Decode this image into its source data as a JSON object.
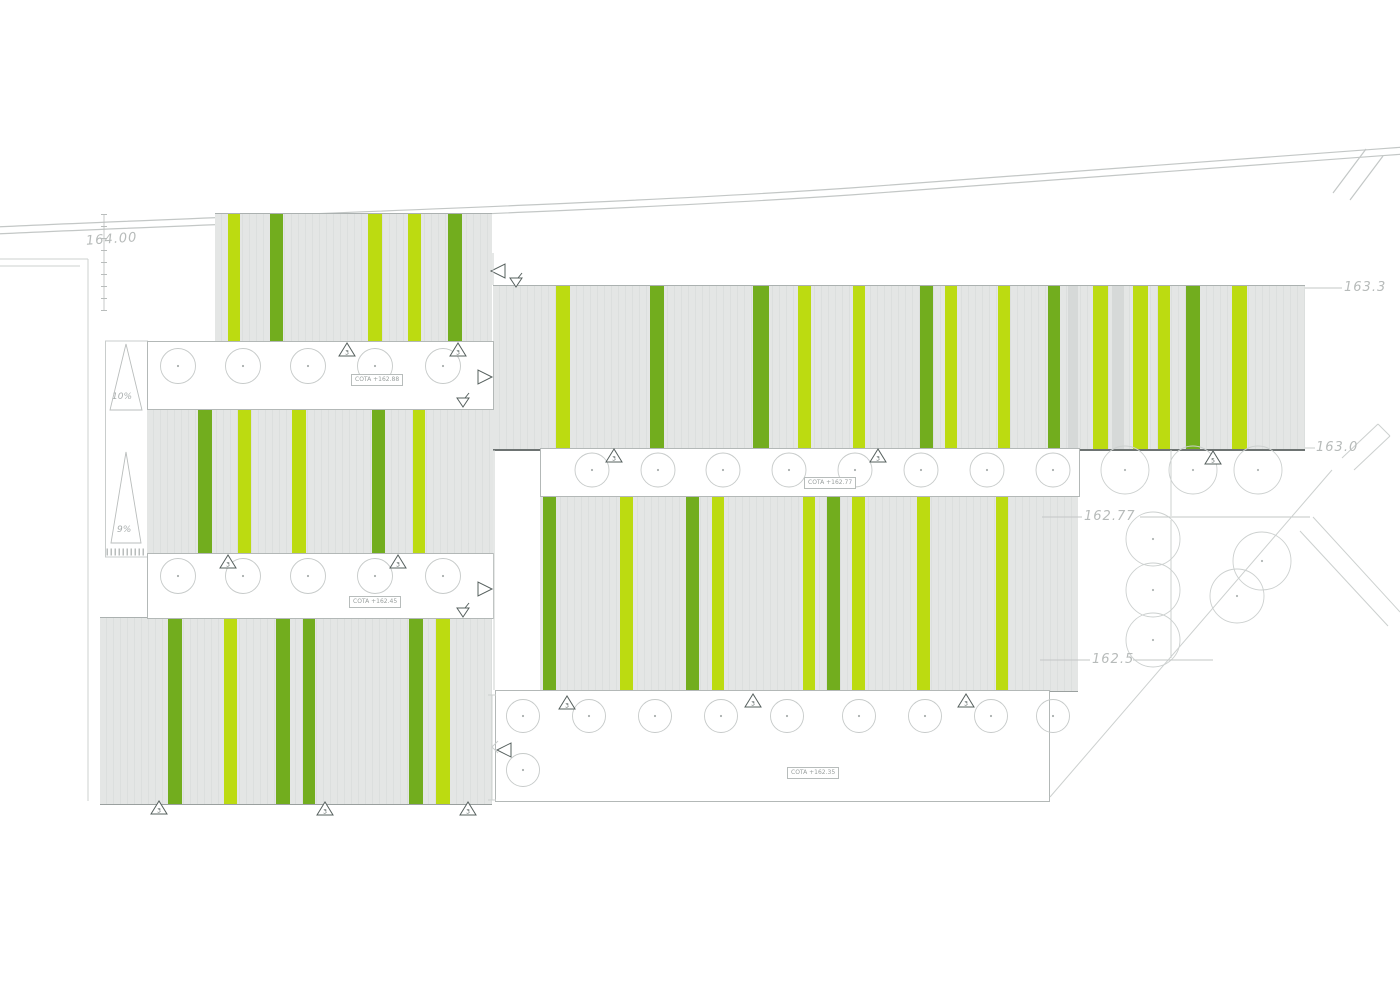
{
  "drawing": {
    "type": "architectural-site-roof-plan",
    "description": "Site plan with striped roof blocks, column grids, ramps and elevation levels"
  },
  "colors": {
    "lime": "#bcdb11",
    "green": "#72ad1e",
    "shadow": "#d6d9d8",
    "roof_gray": "#e4e6e5",
    "line_light": "#ccd0cf",
    "line_mid": "#b3b8b7",
    "line_dark": "#56605e",
    "text_gray": "#b7bbba"
  },
  "labels": {
    "elev_164": "164.00",
    "elev_163_3": "163.3",
    "elev_163_0": "163.0",
    "elev_162_77": "162.77",
    "elev_162_5": "162.5",
    "slope_upper": "10%",
    "slope_lower": "9%"
  },
  "cota": {
    "band1": "COTA +162.88",
    "band2": "COTA +162.45",
    "band3": "COTA +162.77",
    "band4": "COTA +162.35"
  },
  "blocks": [
    {
      "id": "roof-block-a",
      "x": 215,
      "y": 213,
      "w": 277,
      "h": 128,
      "dark": false,
      "stripes": [
        [
          228,
          12,
          "L"
        ],
        [
          270,
          13,
          "G"
        ],
        [
          368,
          14,
          "L"
        ],
        [
          408,
          13,
          "L"
        ],
        [
          448,
          14,
          "G"
        ]
      ]
    },
    {
      "id": "roof-block-b",
      "x": 147,
      "y": 408,
      "w": 346,
      "h": 146,
      "dark": false,
      "stripes": [
        [
          198,
          14,
          "G"
        ],
        [
          238,
          13,
          "L"
        ],
        [
          292,
          14,
          "L"
        ],
        [
          372,
          13,
          "G"
        ],
        [
          413,
          12,
          "L"
        ]
      ]
    },
    {
      "id": "roof-block-c",
      "x": 100,
      "y": 617,
      "w": 392,
      "h": 186,
      "dark": false,
      "stripes": [
        [
          168,
          14,
          "G"
        ],
        [
          224,
          13,
          "L"
        ],
        [
          276,
          14,
          "G"
        ],
        [
          303,
          12,
          "G"
        ],
        [
          409,
          14,
          "G"
        ],
        [
          436,
          14,
          "L"
        ]
      ]
    },
    {
      "id": "roof-block-d",
      "x": 493,
      "y": 285,
      "w": 812,
      "h": 163,
      "dark": true,
      "stripes": [
        [
          556,
          14,
          "L"
        ],
        [
          650,
          14,
          "G"
        ],
        [
          753,
          16,
          "G"
        ],
        [
          798,
          13,
          "L"
        ],
        [
          853,
          12,
          "L"
        ],
        [
          920,
          13,
          "G"
        ],
        [
          945,
          12,
          "L"
        ],
        [
          998,
          12,
          "L"
        ],
        [
          1048,
          12,
          "G"
        ],
        [
          1068,
          10,
          "S"
        ],
        [
          1093,
          15,
          "L"
        ],
        [
          1112,
          12,
          "S"
        ],
        [
          1133,
          15,
          "L"
        ],
        [
          1158,
          12,
          "L"
        ],
        [
          1186,
          14,
          "G"
        ],
        [
          1232,
          15,
          "L"
        ]
      ]
    },
    {
      "id": "roof-block-e",
      "x": 540,
      "y": 495,
      "w": 538,
      "h": 195,
      "dark": false,
      "stripes": [
        [
          543,
          13,
          "G"
        ],
        [
          620,
          13,
          "L"
        ],
        [
          686,
          13,
          "G"
        ],
        [
          712,
          12,
          "L"
        ],
        [
          803,
          12,
          "L"
        ],
        [
          827,
          13,
          "G"
        ],
        [
          852,
          13,
          "L"
        ],
        [
          917,
          13,
          "L"
        ],
        [
          996,
          12,
          "L"
        ]
      ]
    }
  ],
  "bands": [
    {
      "id": "column-band-1",
      "x": 147,
      "y": 341,
      "w": 345,
      "h": 67
    },
    {
      "id": "column-band-2",
      "x": 147,
      "y": 553,
      "w": 345,
      "h": 64
    },
    {
      "id": "column-band-3",
      "x": 540,
      "y": 448,
      "w": 538,
      "h": 47
    },
    {
      "id": "column-band-4",
      "x": 495,
      "y": 690,
      "w": 553,
      "h": 110
    }
  ],
  "column_rows": [
    {
      "cy": 366,
      "r": 17.5,
      "cx": [
        178,
        243,
        308,
        375,
        443
      ]
    },
    {
      "cy": 576,
      "r": 17.5,
      "cx": [
        178,
        243,
        308,
        375,
        443
      ]
    },
    {
      "cy": 470,
      "r": 17,
      "cx": [
        592,
        658,
        723,
        789,
        855,
        921,
        987,
        1053
      ]
    },
    {
      "cy": 716,
      "r": 16.5,
      "cx": [
        523,
        589,
        655,
        721,
        787,
        859,
        925,
        991,
        1053
      ]
    },
    {
      "cy": 770,
      "r": 16.5,
      "cx": [
        523
      ]
    }
  ],
  "trees": [
    {
      "cx": 1125,
      "cy": 470,
      "r": 24
    },
    {
      "cx": 1193,
      "cy": 470,
      "r": 24
    },
    {
      "cx": 1258,
      "cy": 470,
      "r": 24
    },
    {
      "cx": 1153,
      "cy": 539,
      "r": 27
    },
    {
      "cx": 1153,
      "cy": 590,
      "r": 27
    },
    {
      "cx": 1153,
      "cy": 640,
      "r": 27
    },
    {
      "cx": 1262,
      "cy": 561,
      "r": 29
    },
    {
      "cx": 1237,
      "cy": 596,
      "r": 27
    }
  ],
  "markers": [
    {
      "x": 347,
      "y": 350,
      "n": "3"
    },
    {
      "x": 458,
      "y": 350,
      "n": "3"
    },
    {
      "x": 228,
      "y": 562,
      "n": "3"
    },
    {
      "x": 398,
      "y": 562,
      "n": "3"
    },
    {
      "x": 614,
      "y": 456,
      "n": "3"
    },
    {
      "x": 878,
      "y": 456,
      "n": "3"
    },
    {
      "x": 1213,
      "y": 458,
      "n": "5"
    },
    {
      "x": 567,
      "y": 703,
      "n": "3"
    },
    {
      "x": 753,
      "y": 701,
      "n": "3"
    },
    {
      "x": 966,
      "y": 701,
      "n": "3"
    },
    {
      "x": 159,
      "y": 808,
      "n": "3"
    },
    {
      "x": 325,
      "y": 809,
      "n": "3"
    },
    {
      "x": 468,
      "y": 809,
      "n": "3"
    }
  ],
  "arrows": [
    {
      "type": "right",
      "x": 484,
      "y": 377
    },
    {
      "type": "right",
      "x": 484,
      "y": 589
    },
    {
      "type": "left",
      "x": 499,
      "y": 271
    },
    {
      "type": "left",
      "x": 505,
      "y": 750
    },
    {
      "type": "flag",
      "x": 516,
      "y": 282
    },
    {
      "type": "flag",
      "x": 463,
      "y": 402
    },
    {
      "type": "flag",
      "x": 463,
      "y": 612
    }
  ],
  "leaders": [
    {
      "x1": 1305,
      "y1": 288,
      "x2": 1342,
      "y2": 288
    },
    {
      "x1": 1305,
      "y1": 448,
      "x2": 1315,
      "y2": 448
    },
    {
      "x1": 1042,
      "y1": 517,
      "x2": 1082,
      "y2": 517
    },
    {
      "x1": 1140,
      "y1": 517,
      "x2": 1310,
      "y2": 517
    },
    {
      "x1": 1040,
      "y1": 660,
      "x2": 1090,
      "y2": 660
    },
    {
      "x1": 1133,
      "y1": 660,
      "x2": 1213,
      "y2": 660
    }
  ],
  "site_lines": [
    {
      "x1": -5,
      "y1": 259,
      "x2": 88,
      "y2": 259
    },
    {
      "x1": 88,
      "y1": 259,
      "x2": 88,
      "y2": 801
    },
    {
      "x1": -5,
      "y1": 266,
      "x2": 80,
      "y2": 266
    },
    {
      "x1": 493,
      "y1": 253,
      "x2": 493,
      "y2": 285
    },
    {
      "x1": 494,
      "y1": 450,
      "x2": 494,
      "y2": 690
    },
    {
      "x1": 1171,
      "y1": 450,
      "x2": 1171,
      "y2": 516
    },
    {
      "x1": 1171,
      "y1": 520,
      "x2": 1171,
      "y2": 658
    },
    {
      "x1": 1332,
      "y1": 470,
      "x2": 1050,
      "y2": 797
    },
    {
      "x1": 1313,
      "y1": 517,
      "x2": 1400,
      "y2": 612
    },
    {
      "x1": 1300,
      "y1": 531,
      "x2": 1388,
      "y2": 626
    },
    {
      "x1": 1342,
      "y1": 458,
      "x2": 1378,
      "y2": 424
    },
    {
      "x1": 1354,
      "y1": 470,
      "x2": 1390,
      "y2": 436
    },
    {
      "x1": 1378,
      "y1": 424,
      "x2": 1390,
      "y2": 436
    },
    {
      "x1": 492,
      "y1": 695,
      "x2": 492,
      "y2": 800
    },
    {
      "x1": 488,
      "y1": 695,
      "x2": 496,
      "y2": 695
    },
    {
      "x1": 488,
      "y1": 800,
      "x2": 496,
      "y2": 800
    },
    {
      "x1": 492,
      "y1": 747,
      "x2": 498,
      "y2": 741
    },
    {
      "x1": 492,
      "y1": 747,
      "x2": 498,
      "y2": 753
    }
  ],
  "road": {
    "paths": [
      "M -5 227 C 250 215 600 205 850 188 S 1250 158 1405 147",
      "M -5 234 C 250 222 600 212 850 195 S 1250 165 1405 154"
    ],
    "branches": [
      {
        "x1": 1333,
        "y1": 193,
        "x2": 1366,
        "y2": 149
      },
      {
        "x1": 1350,
        "y1": 200,
        "x2": 1383,
        "y2": 156
      }
    ]
  },
  "ticked_line": {
    "x": 104,
    "y1": 214,
    "y2": 311
  },
  "ramp": {
    "rect": {
      "x": 105.5,
      "y": 341,
      "w": 42,
      "h": 216
    },
    "triangles": [
      [
        [
          126,
          344
        ],
        [
          110,
          410
        ],
        [
          142,
          410
        ]
      ],
      [
        [
          126,
          452
        ],
        [
          111,
          543
        ],
        [
          141,
          543
        ]
      ]
    ],
    "hatch_y": 552
  }
}
